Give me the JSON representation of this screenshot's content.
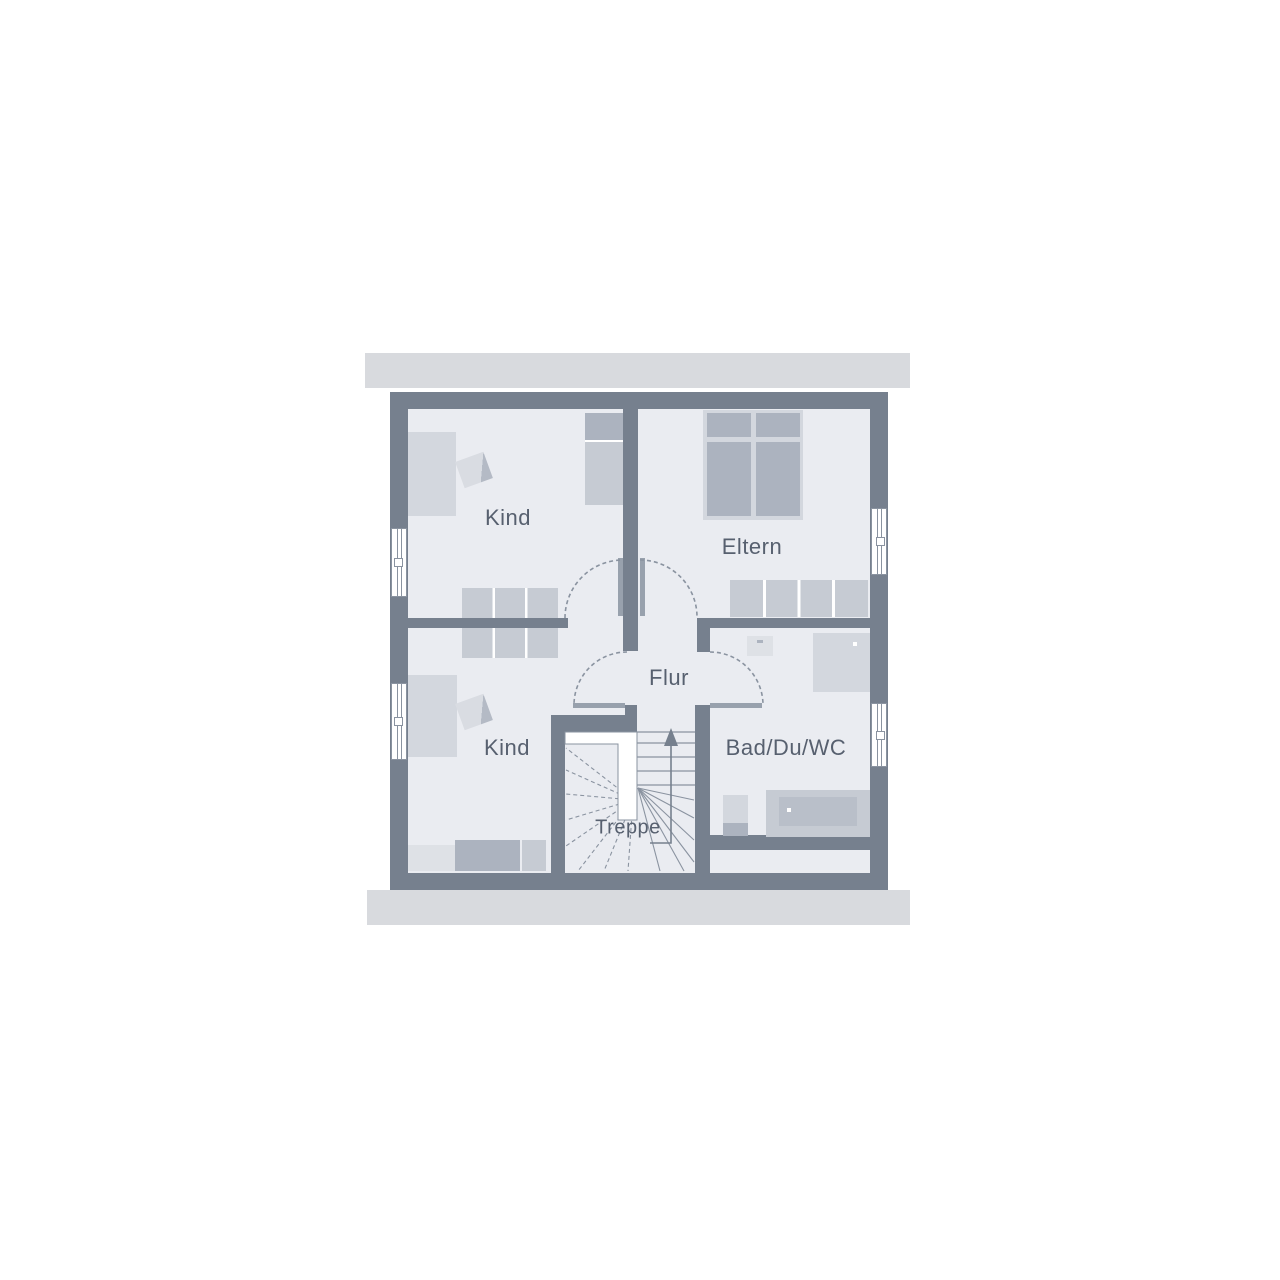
{
  "plan": {
    "type": "floor-plan-upper-storey",
    "labels": {
      "room_kind_top": "Kind",
      "room_eltern": "Eltern",
      "room_kind_bottom": "Kind",
      "hall": "Flur",
      "bathroom": "Bad/Du/WC",
      "stairs": "Treppe"
    }
  },
  "colors": {
    "wall": "#76808E",
    "floor": "#EAECF1",
    "slab": "#D8DADE",
    "furn_light": "#D3D7DE",
    "furn_lighter": "#DEE1E6",
    "furn_mid": "#C6CBD3",
    "furn_dark": "#ACB3BF",
    "tub_inner": "#B9BFC9",
    "line": "#8A93A0",
    "label": "#57606F",
    "door_leaf": "#98A1AD",
    "white": "#FFFFFF"
  }
}
